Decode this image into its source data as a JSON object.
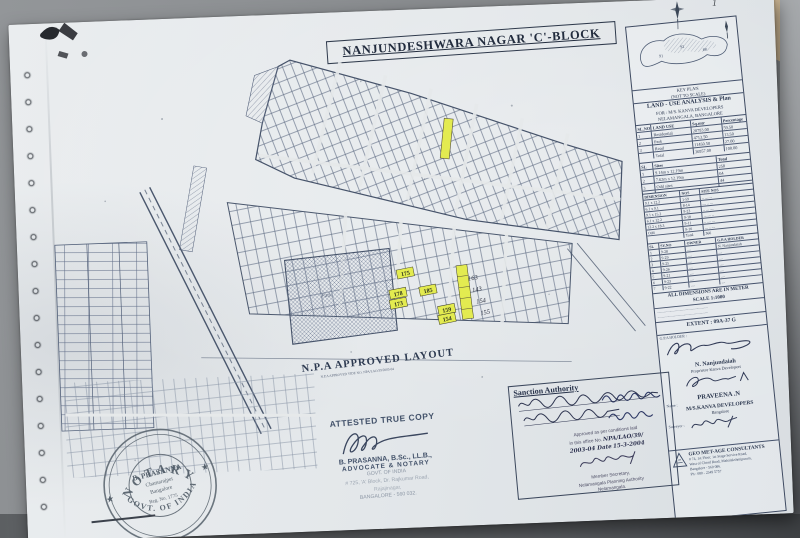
{
  "colors": {
    "paper": "#e7eaec",
    "ink": "#2c3850",
    "map_line": "#5d6a82",
    "highlight": "#e3eb50",
    "stamp_ink": "#5a656f",
    "desk": "#87898c",
    "desk_wood": "#c8b292"
  },
  "page_marks": {
    "top_right": "1"
  },
  "title": {
    "text": "NANJUNDESHWARA NAGAR 'C'-BLOCK"
  },
  "map": {
    "npa_label": "N.P.A APPROVED LAYOUT",
    "npa_sub": "N.P.A APPROVED VIDE NO. NPA/LAO/39/2003-04",
    "park_label": "Park",
    "plots": [
      "175",
      "185",
      "178",
      "173",
      "159",
      "154"
    ],
    "hand_numbers": [
      "163",
      "143",
      "154",
      "155"
    ]
  },
  "right_panel": {
    "keymap_caption1": "KEY PLAN",
    "keymap_caption2": "(NOT TO SCALE)",
    "analysis_title": "LAND - USE ANALYSIS & Plan",
    "analysis_sub1": "FOR : M/S. KANVA DEVELOPERS",
    "analysis_sub2": "NELAMANGALA, BANGALORE",
    "land_use": {
      "h": [
        "SL.NO",
        "LAND USE",
        "Sq.mtr",
        "Percentage"
      ],
      "rows": [
        [
          "1",
          "Residential",
          "20793.00",
          "59.50"
        ],
        [
          "2",
          "Park",
          "4713.50",
          "13.50"
        ],
        [
          "3",
          "Road",
          "11450.50",
          "27.00"
        ],
        [
          "",
          "Total",
          "36957.00",
          "100.00"
        ]
      ]
    },
    "sites": {
      "h": [
        "SL",
        "Sites",
        "Total"
      ],
      "rows": [
        [
          "1",
          "9.14m x 12.19m",
          "258"
        ],
        [
          "2",
          "7.62m x 12.19m",
          "64"
        ],
        [
          "3",
          "Odd sites",
          "44"
        ],
        [
          "",
          "Total",
          "366"
        ]
      ]
    },
    "dims": {
      "h": [
        "DIMENSION",
        "NOS",
        "SITE NOS"
      ],
      "rows": [
        [
          "9.1 x 12.2",
          "1-59",
          ".. .... ..."
        ],
        [
          "6.1 x 9.1",
          "8-14",
          ".... .. ..."
        ],
        [
          "9.1 x 15.2",
          "9-23",
          ".. ... ...."
        ],
        [
          "6.1 x 12.2",
          "9-18",
          "... .... .."
        ],
        [
          "12.2 x 18.3",
          "9-11",
          ".. .... ..."
        ],
        [
          "Odd",
          "9-16",
          "... .. ...."
        ],
        [
          "",
          "Total",
          "366"
        ]
      ]
    },
    "survey": {
      "h": [
        "SL",
        "SY.NO",
        "OWNER",
        "G.P.A HOLDER"
      ],
      "rows": [
        [
          "1",
          "9-28",
          "....",
          "N. Nanjundaiah"
        ],
        [
          "2",
          "9-29",
          "....",
          "...."
        ],
        [
          "3",
          "9-25",
          "....",
          "...."
        ],
        [
          "4",
          "9-26",
          "....",
          "...."
        ],
        [
          "5",
          "9-21",
          "....",
          "...."
        ],
        [
          "6",
          "9-23",
          "....",
          "...."
        ],
        [
          "7",
          "9-22",
          "....",
          "...."
        ]
      ]
    },
    "note1": "ALL DIMENSIONS ARE IN METER",
    "note2": "SCALE 1:1000",
    "cond1": "............................................................",
    "cond2": "............................................................",
    "cond3": "............................................................",
    "extent": "EXTENT : 09A-37 G",
    "sig_label": "G.P.A HOLDER :",
    "name1": "N. Nanjundaiah",
    "name1_sub": "Proprietor Kanva Developers",
    "name2": "PRAVEENA .N",
    "firm_label": "Name :",
    "firm": "M/S.KANVA DEVELOPERS",
    "firm_city": "Bangalore",
    "surveyor_label": "Surveyor :",
    "geo": {
      "name": "GEO MET-AGE CONSULTANTS",
      "a1": "# 74, 1st Floor, 1st Stage Service Road,",
      "a2": "West of Chord Road, Mahalakshmipuram,",
      "a3": "Bangalore - 560 086.",
      "a4": "Ph : 080 - 2349 5757"
    }
  },
  "sanction": {
    "header": "Sanction Authority",
    "stamp_line1": "Approved as per conditions laid",
    "stamp_line2_pre": "in this office      No.",
    "stamp_no": "NPA/LAO/39/",
    "stamp_line3_pre": "2003-04      Date",
    "stamp_date": "15-3-2004",
    "auth1": "Member Secretary,",
    "auth2": "Nelamangala Planning Authority",
    "auth3": "Nelamangala."
  },
  "attested": {
    "title": "ATTESTED TRUE COPY",
    "name": "B. PRASANNA, B.Sc., LL.B.,",
    "role": "ADVOCATE & NOTARY",
    "govt": "GOVT. OF INDIA",
    "addr1": "# 725, 'A' Block, Dr. Rajkumar Road,",
    "addr2": "Rajajinagar,",
    "addr3": "BANGALORE - 560 032."
  },
  "notary": {
    "arc_top": "NOTARY",
    "arc_bottom": "GOVT. OF INDIA",
    "line1": "B. PRASANNA",
    "line2": "Chamarajpet",
    "line3": "Bangalore",
    "line4": "Reg. No. 1775"
  }
}
